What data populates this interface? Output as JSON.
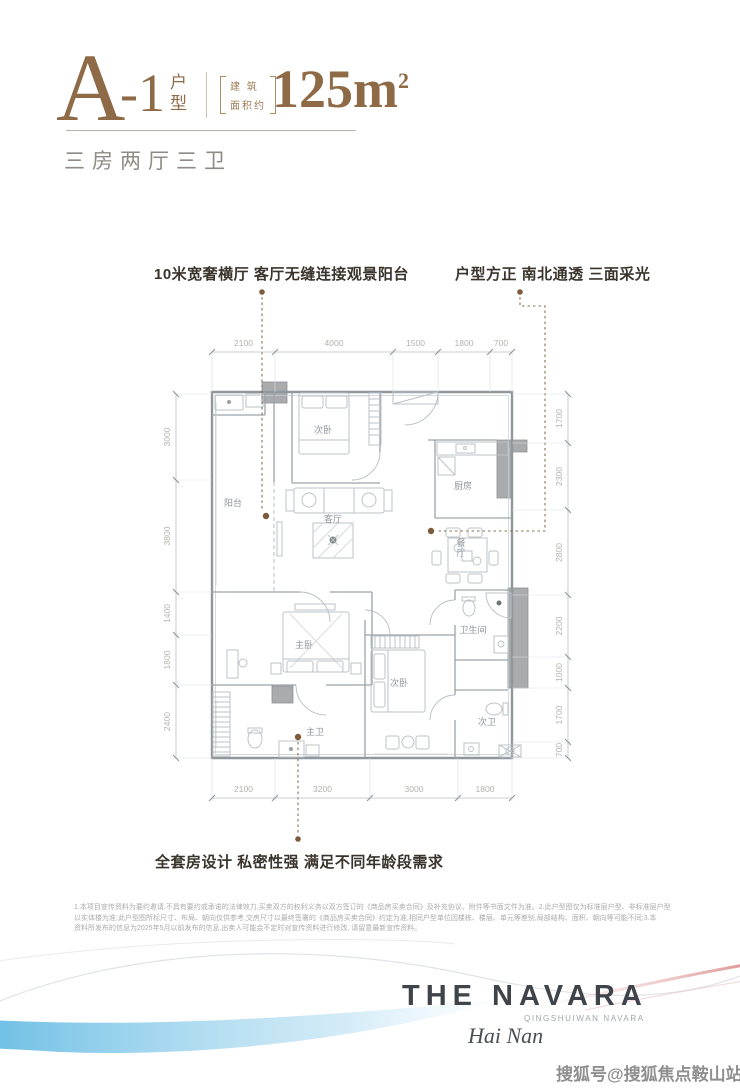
{
  "header": {
    "plan_letter": "A",
    "plan_suffix": "-1",
    "plan_type_vertical": [
      "户",
      "型"
    ],
    "area_prefix_line1": "建 筑",
    "area_prefix_line2": "面积约",
    "area_value": "125m",
    "area_sup": "2",
    "rooms_summary": "三房两厅三卫"
  },
  "callouts": {
    "left": "10米宽奢横厅 客厅无缝连接观景阳台",
    "right": "户型方正 南北通透 三面采光",
    "bottom": "全套房设计 私密性强 满足不同年龄段需求"
  },
  "floorplan": {
    "dimensions": {
      "top": [
        "2100",
        "4000",
        "1500",
        "1800",
        "700"
      ],
      "bottom": [
        "2100",
        "3200",
        "3000",
        "1800"
      ],
      "left": [
        "3000",
        "3800",
        "1400",
        "1800",
        "2400"
      ],
      "right": [
        "1700",
        "2300",
        "2800",
        "2200",
        "1000",
        "1700",
        "700"
      ]
    },
    "rooms": [
      "阳台",
      "次卧",
      "厨房",
      "客厅",
      "餐厅",
      "主卧",
      "主卫",
      "次卧",
      "卫生间",
      "次卫"
    ]
  },
  "disclaimer": {
    "lines": [
      "1.本项目宣传资料为要约邀请,不具有要约或承诺的法律效力,买卖双方的权利义务以双方签订的《商品房买卖合同》及补充协议、附件等书面文件为准。2.此户型图仅为标准层户型、非标准层户型",
      "以实体楼为准;此户型图所标尺寸、布局、朝向仅供参考,交房尺寸以最终签署的《商品房买卖合同》约定为准;相同户型单位因楼栋、楼层、单元等差别,局部结构、面积、朝向等可能不同;3.本",
      "资料所发布的信息为2025年5月以前发布的信息,出卖人可能会不定时对宣传资料进行修改, 请留意最新宣传资料。"
    ]
  },
  "brand": {
    "name": "THE NAVARA",
    "subtitle": "QINGSHUIWAN NAVARA",
    "region": "Hai Nan"
  },
  "watermark": "搜狐号@搜狐焦点鞍山站",
  "colors": {
    "accent_brown": "#8e6b46",
    "callout_dot": "#7c5c3c",
    "wall_gray": "#8f979d",
    "dim_gray": "#b3b1ac",
    "swoosh_blue": "#54b4e0",
    "swoosh_red": "#d97f7f"
  }
}
